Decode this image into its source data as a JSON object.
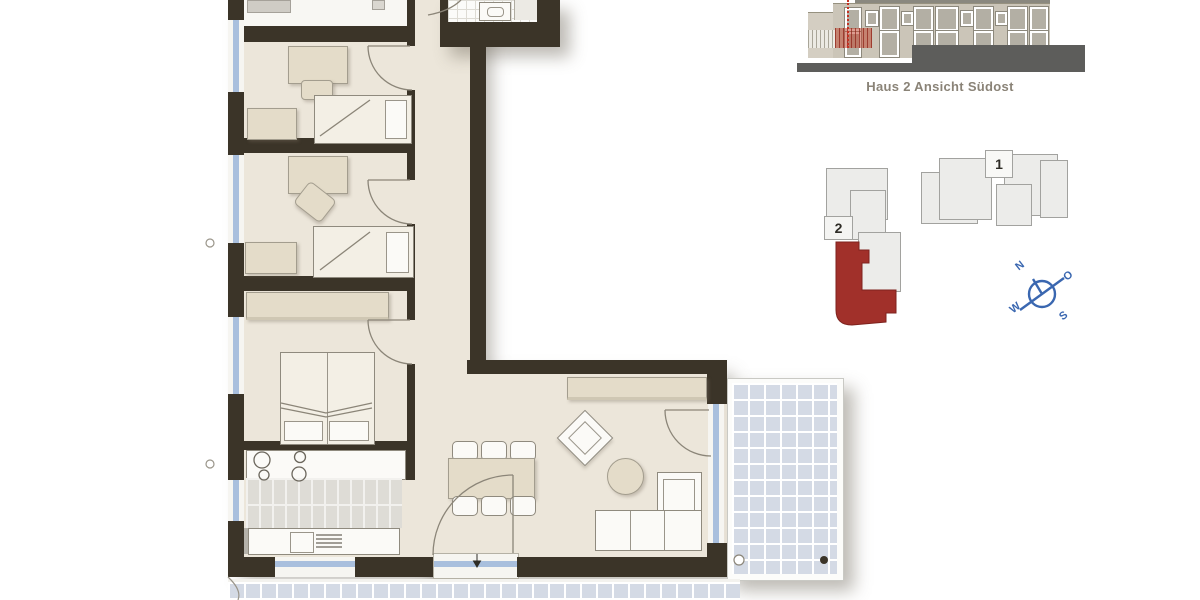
{
  "elevation": {
    "caption": "Haus 2 Ansicht Südost"
  },
  "siteplan": {
    "building1_label": "1",
    "building2_label": "2",
    "highlight_color": "#a1302a"
  },
  "compass": {
    "n": "N",
    "o": "O",
    "s": "S",
    "w": "W",
    "color": "#3a67b0"
  },
  "plan_colors": {
    "wall": "#3b3428",
    "floor": "#ece6da",
    "window_blue": "#a9bfdd",
    "terrace_tile": "#d4dae5",
    "furniture_beige": "#e4dcc9"
  }
}
